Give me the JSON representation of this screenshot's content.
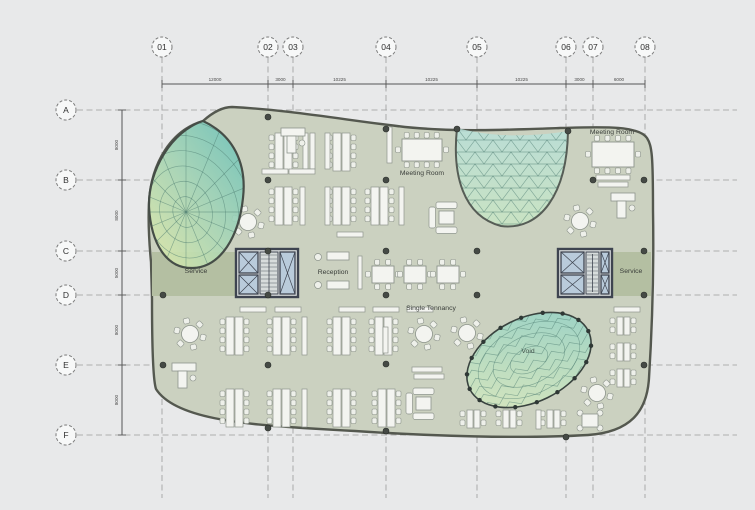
{
  "plan": {
    "grid_columns": [
      "01",
      "02",
      "03",
      "04",
      "05",
      "06",
      "07",
      "08"
    ],
    "grid_rows": [
      "A",
      "B",
      "C",
      "D",
      "E",
      "F"
    ],
    "dims_top": [
      "12000",
      "3000",
      "10225",
      "10225",
      "10225",
      "3000",
      "6000"
    ],
    "dims_left": [
      "8000",
      "8000",
      "5000",
      "8000",
      "8000"
    ],
    "labels": {
      "meeting_room_center": "Meeting Room",
      "meeting_room_top_right": "Meeting Room",
      "service_left": "Service",
      "service_right": "Service",
      "reception": "Reception",
      "single_tenancy": "Single Tennancy",
      "void": "Void"
    },
    "colors": {
      "background": "#e8e9ea",
      "floor": "#cbd1c0",
      "service_band": "#b4bfa2",
      "outline": "#54584f",
      "core_wall": "#3e4450",
      "lift_fill": "#b9cbdb",
      "stair_fill": "#d7dcdc",
      "furniture_fill": "#f3f4f0",
      "furniture_stroke": "#8d948c",
      "dome_teal": "#74c5ba",
      "dome_mid": "#a9d6b8",
      "dome_green": "#d5e5a9",
      "dome2_top": "#b8dfd8",
      "dome2_bottom": "#c9e5c3",
      "mesh_line": "#4b7a6f",
      "grid_line": "#9a9a9a",
      "dim_line": "#555555",
      "text": "#3a3e3a",
      "node_dot": "#454a45"
    }
  }
}
